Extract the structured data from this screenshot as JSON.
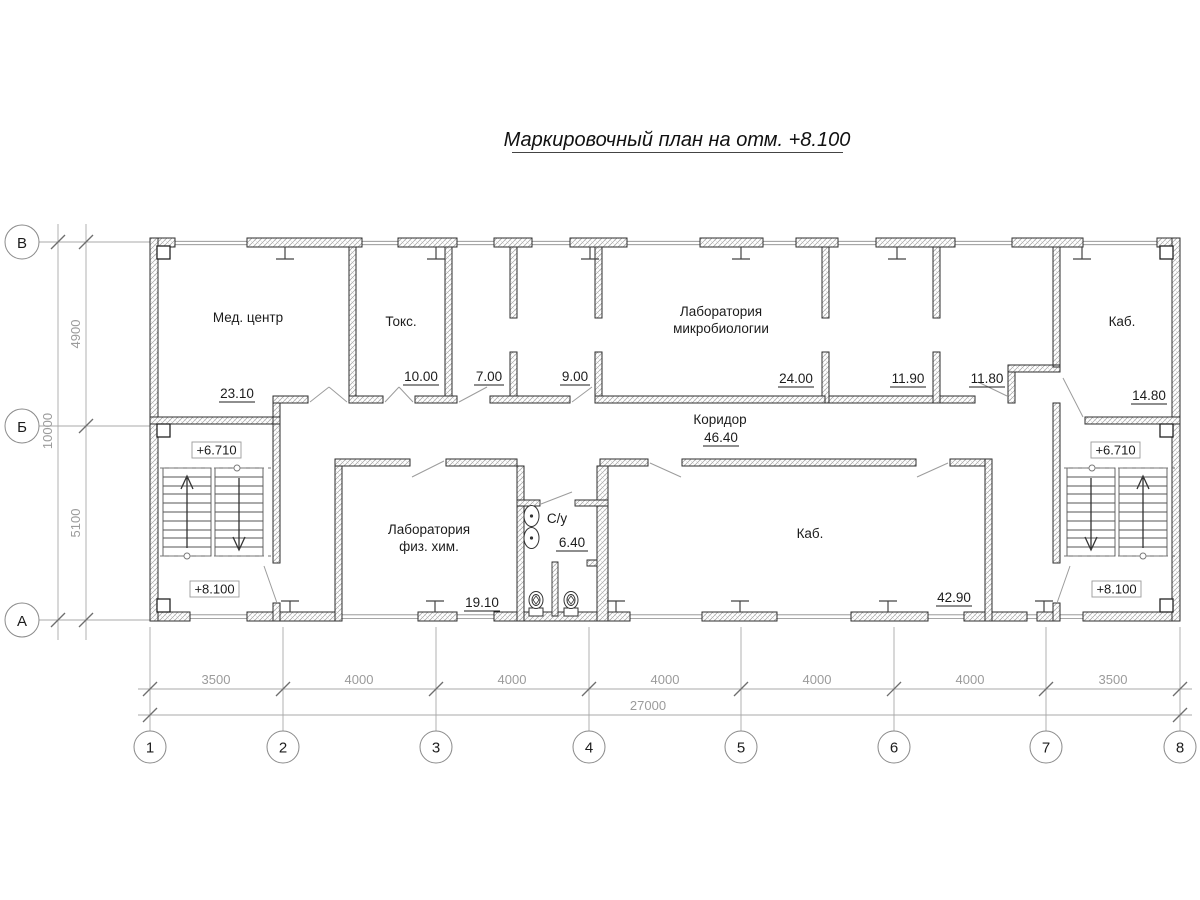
{
  "title": "Маркировочный план на отм. +8.100",
  "rooms": {
    "med_center": {
      "name": "Мед. центр",
      "area": "23.10"
    },
    "toks": {
      "name": "Токс.",
      "area": "10.00"
    },
    "room_7": {
      "area": "7.00"
    },
    "room_9": {
      "area": "9.00"
    },
    "micro_lab": {
      "name1": "Лаборатория",
      "name2": "микробиологии",
      "area": "24.00"
    },
    "room_1190": {
      "area": "11.90"
    },
    "room_1180": {
      "area": "11.80"
    },
    "kab_top_right": {
      "name": "Каб.",
      "area": "14.80"
    },
    "corridor": {
      "name": "Коридор",
      "area": "46.40"
    },
    "phys_chem_lab": {
      "name1": "Лаборатория",
      "name2": "физ. хим.",
      "area": "19.10"
    },
    "su": {
      "name": "С/у",
      "area": "6.40"
    },
    "kab_center": {
      "name": "Каб.",
      "area": "42.90"
    }
  },
  "elevations": {
    "upper": "+6.710",
    "lower": "+8.100"
  },
  "axes": {
    "bottom": [
      "1",
      "2",
      "3",
      "4",
      "5",
      "6",
      "7",
      "8"
    ],
    "left": [
      "В",
      "Б",
      "А"
    ]
  },
  "dims": {
    "h_segments": [
      "3500",
      "4000",
      "4000",
      "4000",
      "4000",
      "4000",
      "3500"
    ],
    "h_total": "27000",
    "v_segments": [
      "4900",
      "5100"
    ],
    "v_total": "10000"
  }
}
